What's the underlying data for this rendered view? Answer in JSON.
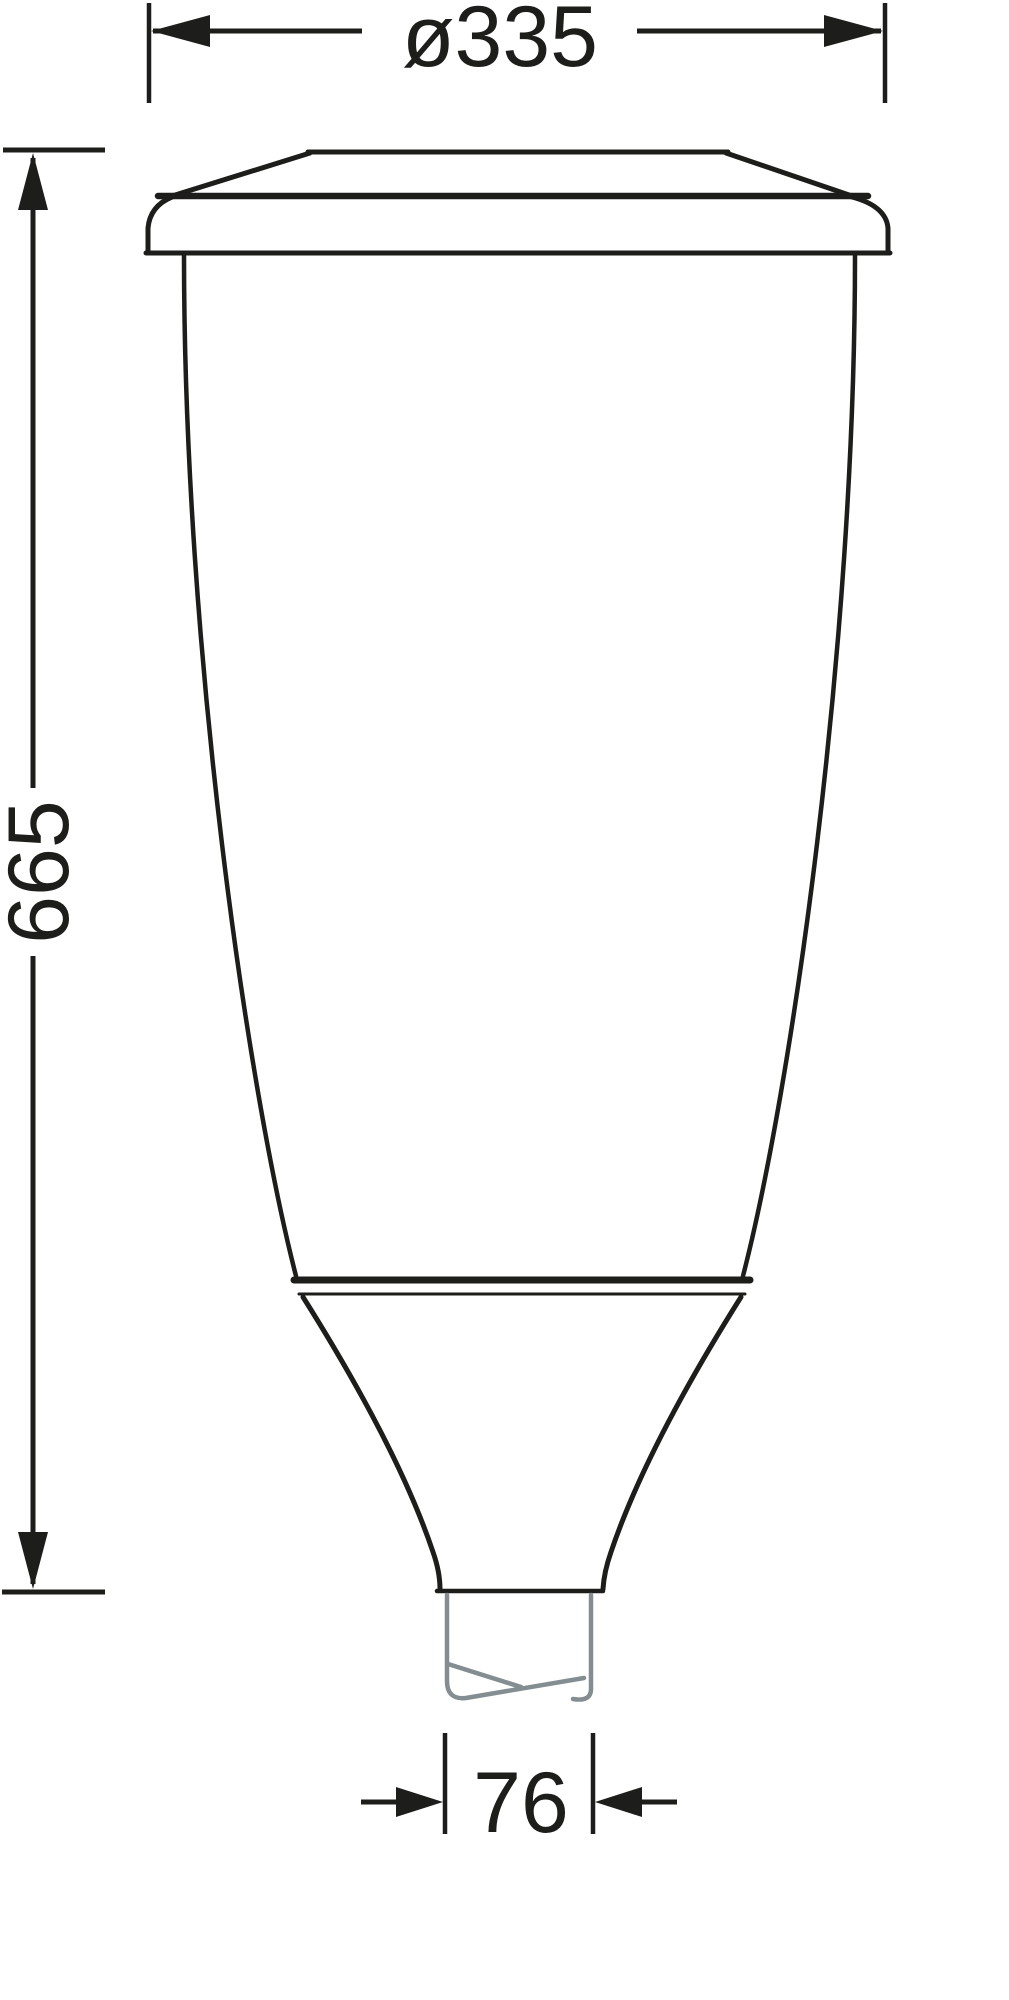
{
  "drawing": {
    "dimensions": {
      "width": {
        "label": "ø335"
      },
      "height": {
        "label": "665"
      },
      "spigot": {
        "label": "76"
      }
    },
    "colors": {
      "line": "#1d1d1b",
      "pole": "#848d92",
      "background": "#ffffff"
    }
  }
}
